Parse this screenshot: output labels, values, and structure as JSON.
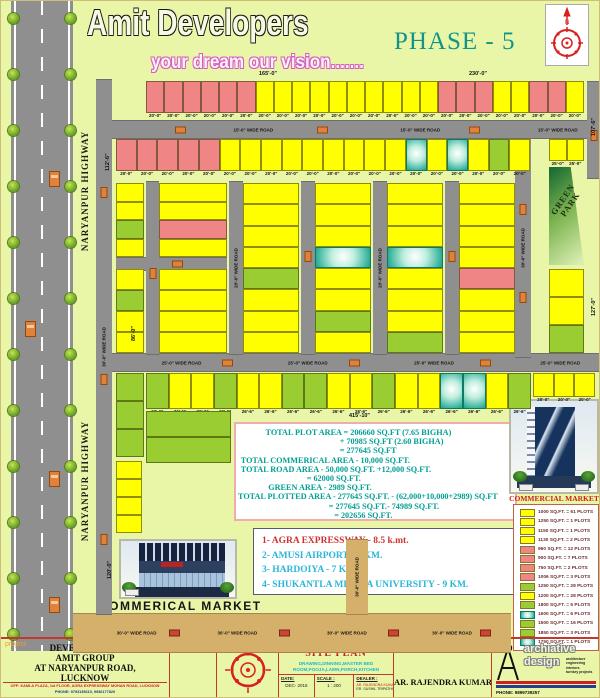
{
  "header": {
    "brand": "Amit Developers",
    "tagline": "your dream our vision.......",
    "phase": "PHASE - 5"
  },
  "highway": {
    "label": "NARYANPUR HIGHWAY"
  },
  "road_labels": {
    "r15": "15'-0\" WIDE ROAD",
    "r20": "20'-0\" WIDE ROAD",
    "r25": "25'-0\" WIDE ROAD",
    "r30": "30'-0\" WIDE ROAD"
  },
  "green_park": {
    "line1": "GREEN",
    "line2": "PARK"
  },
  "labels": {
    "commercial_left": "COMMERICAL MARKET",
    "commercial_right": "COMMERCIAL MARKET"
  },
  "edge_dims": [
    {
      "x": 258,
      "y": 70,
      "t": "165'-0\"",
      "rot": 0
    },
    {
      "x": 468,
      "y": 70,
      "t": "230'-0\"",
      "rot": 0
    },
    {
      "x": 104,
      "y": 170,
      "t": "112'-6\"",
      "rot": -90
    },
    {
      "x": 590,
      "y": 135,
      "t": "107'-6\"",
      "rot": -90
    },
    {
      "x": 590,
      "y": 315,
      "t": "127'-0\"",
      "rot": -90
    },
    {
      "x": 130,
      "y": 340,
      "t": "86'-0\"",
      "rot": -90
    },
    {
      "x": 106,
      "y": 578,
      "t": "120'-0\"",
      "rot": -90
    },
    {
      "x": 348,
      "y": 412,
      "t": "415'-10\"",
      "rot": 0
    }
  ],
  "area_summary": {
    "lines": [
      {
        "t": "TOTAL PLOT AREA =  206660 SQ.FT (7.65 BIGHA)",
        "i": 10
      },
      {
        "t": "+ 70985 SQ.FT (2.60 BIGHA)",
        "i": 37
      },
      {
        "t": "= 277645 SQ.FT",
        "i": 37
      },
      {
        "t": "TOTAL COMMERICAL AREA -  10,000 SQ.FT.",
        "i": 1
      },
      {
        "t": "TOTAL ROAD AREA -  50,000 SQ.FT. +12,000 SQ.FT.",
        "i": 1
      },
      {
        "t": "= 62000 SQ.FT.",
        "i": 25
      },
      {
        "t": "GREEN AREA -  2989 SQ.FT.",
        "i": 11
      },
      {
        "t": "TOTAL PLOTTED AREA - 277645 SQ.FT. -  (62,000+10,000+2989)  SQ.FT",
        "i": 0
      },
      {
        "t": "= 277645 SQ.FT.- 74989 SQ.FT.",
        "i": 33
      },
      {
        "t": "= 202656 SQ.FT.",
        "i": 35
      }
    ]
  },
  "distances": [
    {
      "t": "1- AGRA EXPRESSWAY - 8.5 k.mt.",
      "c": "red"
    },
    {
      "t": "2- AMUSI AIRPORT - 8 KM.",
      "c": "cyan"
    },
    {
      "t": "3- HARDOIYA - 7 KM.",
      "c": "cyan"
    },
    {
      "t": "4- SHUKANTLA MISHRA UNIVERSITY - 9 KM.",
      "c": "cyan"
    }
  ],
  "legend": {
    "rows": [
      {
        "s": "Y",
        "t": "1000 SQ.FT. = 61 PLOTS"
      },
      {
        "s": "Y",
        "t": "1250 SQ.FT. = 1 PLOTS"
      },
      {
        "s": "Y",
        "t": "1150 SQ.FT. = 1 PLOTS"
      },
      {
        "s": "Y",
        "t": "1130 SQ.FT. = 2 PLOTS"
      },
      {
        "s": "P",
        "t": "960 SQ.FT. = 12 PLOTS"
      },
      {
        "s": "P",
        "t": "900 SQ.FT. = 7 PLOTS"
      },
      {
        "s": "P",
        "t": "750 SQ.FT. = 2 PLOTS"
      },
      {
        "s": "P",
        "t": "1006 SQ.FT. = 3 PLOTS"
      },
      {
        "s": "G",
        "t": "1250 SQ.FT. = 28 PLOTS"
      },
      {
        "s": "Y",
        "t": "1200 SQ.FT. = 28 PLOTS"
      },
      {
        "s": "G",
        "t": "1800 SQ.FT. = 5 PLOTS"
      },
      {
        "s": "T",
        "t": "1600 SQ.FT. = 6 PLOTS"
      },
      {
        "s": "G",
        "t": "1500 SQ.FT. = 16 PLOTS"
      },
      {
        "s": "G",
        "t": "1850 SQ.FT. = 3 PLOTS"
      },
      {
        "s": "T",
        "t": "1750 SQ.FT. = 1 PLOTS"
      }
    ]
  },
  "plan": {
    "palette": {
      "Y": "#ffff00",
      "P": "#ef8585",
      "G": "#9acd32"
    },
    "bands": [
      {
        "x": 145,
        "y": 80,
        "w": 438,
        "h": 32,
        "dim": "20'-0\"",
        "cells": "PPPPPPYYYYYYYYYYPPPYYPPY"
      },
      {
        "x": 115,
        "y": 138,
        "w": 414,
        "h": 32,
        "dim": "20'-0\"",
        "cells": "PPPPPYYYYYYYYYTYTYGY"
      },
      {
        "x": 548,
        "y": 138,
        "w": 35,
        "h": 22,
        "dim": "25'-0\"",
        "cells": "YY"
      },
      {
        "x": 145,
        "y": 372,
        "w": 385,
        "h": 36,
        "dim": "26'-6\"",
        "cells": "GYYGYYGGYYGYYTTYG"
      },
      {
        "x": 532,
        "y": 372,
        "w": 62,
        "h": 24,
        "dim": "20'-0\"",
        "cells": "YYY"
      }
    ],
    "stacks": [
      {
        "x": 115,
        "y": 182,
        "w": 28,
        "h": 74,
        "cells": "YYGY"
      },
      {
        "x": 115,
        "y": 268,
        "w": 28,
        "h": 84,
        "cells": "YGYY"
      },
      {
        "x": 158,
        "y": 182,
        "w": 68,
        "h": 74,
        "cells": "YYPY"
      },
      {
        "x": 158,
        "y": 268,
        "w": 68,
        "h": 84,
        "cells": "YYYY"
      },
      {
        "x": 242,
        "y": 182,
        "w": 56,
        "h": 170,
        "cells": "YYYYGYYY"
      },
      {
        "x": 314,
        "y": 182,
        "w": 56,
        "h": 170,
        "cells": "YYYTYYGY"
      },
      {
        "x": 386,
        "y": 182,
        "w": 56,
        "h": 170,
        "cells": "YYYTYYYG"
      },
      {
        "x": 458,
        "y": 182,
        "w": 56,
        "h": 170,
        "cells": "YYYYPYYY"
      },
      {
        "x": 548,
        "y": 268,
        "w": 35,
        "h": 84,
        "cells": "YYG"
      },
      {
        "x": 115,
        "y": 372,
        "w": 28,
        "h": 84,
        "cells": "GGG"
      },
      {
        "x": 145,
        "y": 410,
        "w": 85,
        "h": 52,
        "cells": "GG"
      },
      {
        "x": 115,
        "y": 460,
        "w": 26,
        "h": 72,
        "cells": "YYYY"
      }
    ],
    "roads_h": [
      {
        "x": 95,
        "y": 119,
        "w": 491,
        "h": 17,
        "c": "gray",
        "lab": "r15",
        "lx": [
          0.28,
          0.62,
          0.9
        ],
        "cars": [
          0.16,
          0.45,
          0.76
        ]
      },
      {
        "x": 115,
        "y": 256,
        "w": 111,
        "h": 12,
        "c": "gray",
        "lab": null,
        "lx": [],
        "cars": [
          0.5
        ]
      },
      {
        "x": 95,
        "y": 352,
        "w": 505,
        "h": 17,
        "c": "gray",
        "lab": "r25",
        "lx": [
          0.13,
          0.38,
          0.63,
          0.88
        ],
        "cars": [
          0.25,
          0.5,
          0.76
        ]
      },
      {
        "x": 72,
        "y": 612,
        "w": 438,
        "h": 38,
        "c": "tan",
        "lab": "r30",
        "lx": [
          0.1,
          0.33,
          0.58,
          0.82
        ],
        "cars": [
          0.22,
          0.47,
          0.72,
          0.93
        ]
      }
    ],
    "roads_v": [
      {
        "x": 95,
        "y": 78,
        "w": 16,
        "h": 534,
        "c": "gray",
        "lab": "r30",
        "cars": [
          0.2,
          0.55,
          0.85
        ]
      },
      {
        "x": 145,
        "y": 180,
        "w": 13,
        "h": 172,
        "c": "gray",
        "lab": null,
        "cars": [
          0.5
        ]
      },
      {
        "x": 228,
        "y": 180,
        "w": 14,
        "h": 172,
        "c": "gray",
        "lab": "r20",
        "cars": []
      },
      {
        "x": 300,
        "y": 180,
        "w": 14,
        "h": 172,
        "c": "gray",
        "lab": null,
        "cars": [
          0.4
        ]
      },
      {
        "x": 372,
        "y": 180,
        "w": 14,
        "h": 172,
        "c": "gray",
        "lab": "r20",
        "cars": []
      },
      {
        "x": 444,
        "y": 180,
        "w": 14,
        "h": 172,
        "c": "gray",
        "lab": null,
        "cars": [
          0.4
        ]
      },
      {
        "x": 514,
        "y": 137,
        "w": 16,
        "h": 218,
        "c": "gray",
        "lab": "r30",
        "cars": [
          0.3,
          0.7
        ]
      },
      {
        "x": 586,
        "y": 80,
        "w": 14,
        "h": 96,
        "c": "gray",
        "lab": null,
        "cars": [
          0.5
        ]
      },
      {
        "x": 345,
        "y": 538,
        "w": 22,
        "h": 74,
        "c": "tan",
        "lab": "r30",
        "cars": []
      }
    ]
  },
  "title_block": {
    "project": "project",
    "dev_lines": [
      "DEVELOPED BY",
      "AMIT GROUP",
      "AT  NARYANPUR ROAD,",
      "LUCKNOW"
    ],
    "office": "OFF:  KAMLA PLAZA, 1st FLOOR, AGRA EXPRESSWAY MOHAN ROAD, LUCKNOW",
    "phone": "PHONE:  9793135610, 9936177820",
    "north": "NORTH",
    "title_label": "TITLE :",
    "title": "SITE PLAN",
    "subtitle1": "DRAWING,DINNING,MASTER BED",
    "subtitle2": "ROOM,POOJA,LAWN,PORCH,KITCHEN",
    "date_label": "DATE:",
    "date": "DEC- 2018",
    "scale_label": "SCALE :",
    "scale": "1 : 200",
    "dealer_label": "DEALER :",
    "dealer1": "AR. RAJENDRA KUMAR",
    "dealer2": "ER. SUSHIL TRIPATHI",
    "architect_label": "ARCHITECT SIGN :",
    "architect": "AR. RAJENDRA KUMAR",
    "logo1": "archiative",
    "logo2": "design",
    "services": [
      "architecture",
      "engineering",
      "interiors",
      "turnkey projects"
    ],
    "logo_phone": "PHONE:  9899739257"
  }
}
